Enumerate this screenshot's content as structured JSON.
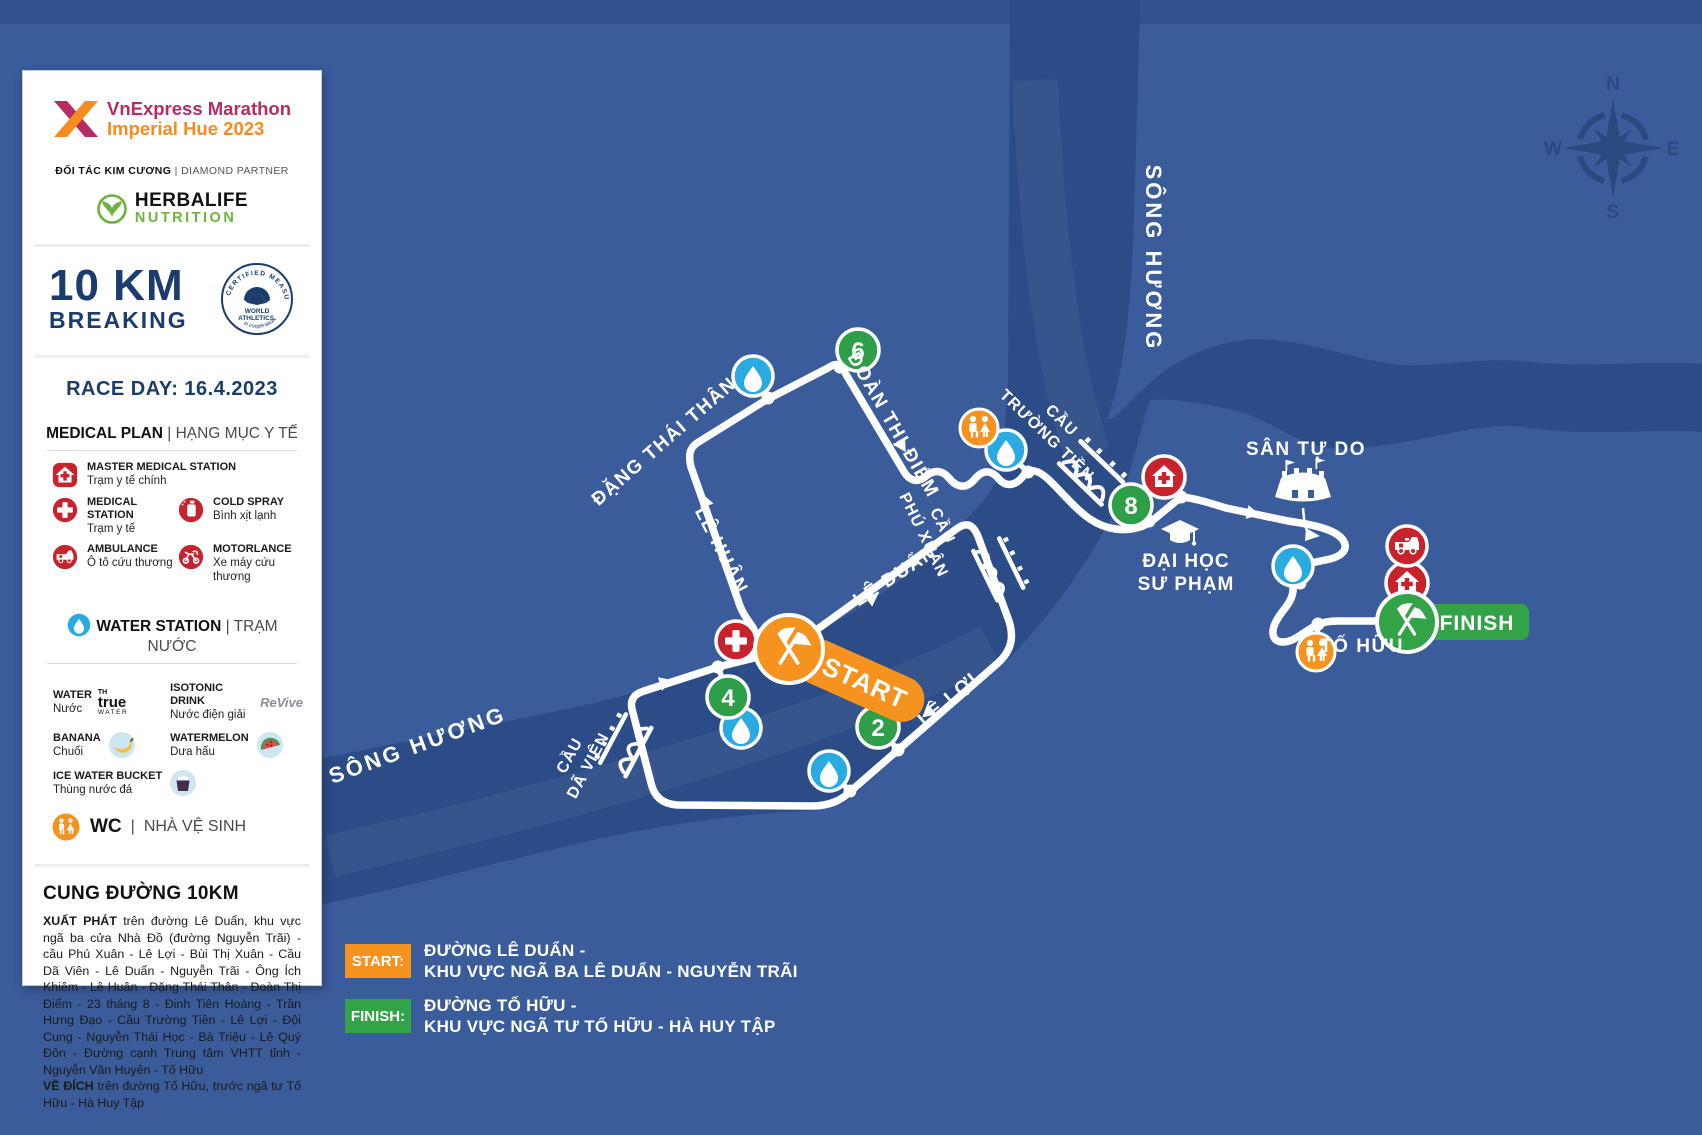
{
  "colors": {
    "bg": "#3A5C9B",
    "river": "#2C4C87",
    "orange": "#F6921E",
    "km_green": "#2F9E48",
    "finish_green": "#33A348",
    "water_blue": "#29ABE2",
    "medical_red": "#C8232C",
    "navy": "#1B3D6E",
    "magenta": "#B72B63"
  },
  "panel": {
    "logo": {
      "line1": "VnExpress Marathon",
      "line2": "Imperial Hue 2023"
    },
    "partner": {
      "left": "ĐỐI TÁC KIM CƯƠNG",
      "sep": "|",
      "right": "DIAMOND PARTNER"
    },
    "herbalife": {
      "line1": "HERBALIFE",
      "line2": "NUTRITION"
    },
    "distance": {
      "big": "10 KM",
      "sub": "BREAKING"
    },
    "badge": {
      "ring_top": "CERTIFIED MEASURED COURSE",
      "ring_bottom": "in cooperation",
      "center1": "WORLD",
      "center2": "ATHLETICS."
    },
    "race_day": "RACE DAY: 16.4.2023",
    "medical": {
      "title": "MEDICAL PLAN",
      "sep": "|",
      "subtitle": "HẠNG MỤC Y TẾ",
      "items": [
        {
          "title": "MASTER MEDICAL STATION",
          "sub": "Trạm y tế chính"
        },
        {
          "title": "MEDICAL STATION",
          "sub": "Trạm y tế"
        },
        {
          "title": "COLD SPRAY",
          "sub": "Bình xịt lạnh"
        },
        {
          "title": "AMBULANCE",
          "sub": "Ô tô cứu thương"
        },
        {
          "title": "MOTORLANCE",
          "sub": "Xe máy cứu thương"
        }
      ]
    },
    "water": {
      "title": "WATER STATION",
      "sep": "|",
      "subtitle": "TRẠM NƯỚC",
      "items": [
        {
          "title": "WATER",
          "sub": "Nước"
        },
        {
          "title": "ISOTONIC DRINK",
          "sub": "Nước điện giải"
        },
        {
          "title": "BANANA",
          "sub": "Chuối"
        },
        {
          "title": "WATERMELON",
          "sub": "Dưa hấu"
        },
        {
          "title": "ICE WATER BUCKET",
          "sub": "Thùng nước đá"
        }
      ],
      "brand_th": {
        "l1": "TH",
        "l2": "true",
        "l3": "WATER"
      },
      "brand_revive": "ReVive",
      "wc": {
        "label": "WC",
        "sep": "|",
        "subtitle": "NHÀ VỆ SINH"
      }
    },
    "course": {
      "title": "CUNG ĐƯỜNG 10KM",
      "start_label": "XUẤT PHÁT",
      "start_text": " trên đường Lê Duẩn, khu vực ngã ba cửa Nhà Đồ (đường Nguyễn Trãi) - cầu Phú Xuân - Lê Lợi - Bùi Thị Xuân - Cầu Dã Viên - Lê Duẩn - Nguyễn Trãi - Ông Ích Khiêm - Lê Huân - Đặng Thái Thân - Đoàn Thị Điểm - 23 tháng 8 - Đinh Tiên Hoàng - Trần Hưng Đạo - Cầu Trường Tiền - Lê Lợi - Đội Cung - Nguyễn Thái Học - Bà Triệu - Lê Quý Đôn - Đường cạnh Trung tâm VHTT tỉnh - Nguyễn Văn Huyên - Tố Hữu",
      "finish_label": "VỀ ĐÍCH",
      "finish_text": " trên đường Tố Hữu, trước ngã tư Tố Hữu - Hà Huy Tập"
    }
  },
  "legend": {
    "start": {
      "label": "START:",
      "line1": "ĐƯỜNG LÊ DUẨN -",
      "line2": "KHU VỰC NGÃ BA LÊ DUẨN - NGUYỄN TRÃI"
    },
    "finish": {
      "label": "FINISH:",
      "line1": "ĐƯỜNG TỐ HỮU -",
      "line2": "KHU VỰC NGÃ TƯ TỐ HỮU - HÀ HUY TẬP"
    }
  },
  "map": {
    "start": "START",
    "finish": "FINISH",
    "km": [
      "2",
      "4",
      "6",
      "8"
    ],
    "streets": [
      "ĐẶNG THÁI THÂN",
      "LÊ HUÂN",
      "ĐOÀN THỊ ĐIỂM",
      "LÊ DUẨN",
      "LÊ LỢI",
      "TỐ HỮU"
    ],
    "rivers": [
      "SÔNG HƯƠNG",
      "SÔNG HƯƠNG"
    ],
    "bridges": [
      {
        "l1": "CẦU",
        "l2": "TRƯỜNG TIỀN"
      },
      {
        "l1": "CẦU",
        "l2": "PHÚ XUÂN"
      },
      {
        "l1": "CẦU",
        "l2": "DÃ VIÊN"
      }
    ],
    "places": {
      "stadium": "SÂN TỰ DO",
      "uni1": "ĐẠI HỌC",
      "uni2": "SƯ PHẠM"
    },
    "compass": {
      "n": "N",
      "e": "E",
      "s": "S",
      "w": "W"
    }
  }
}
